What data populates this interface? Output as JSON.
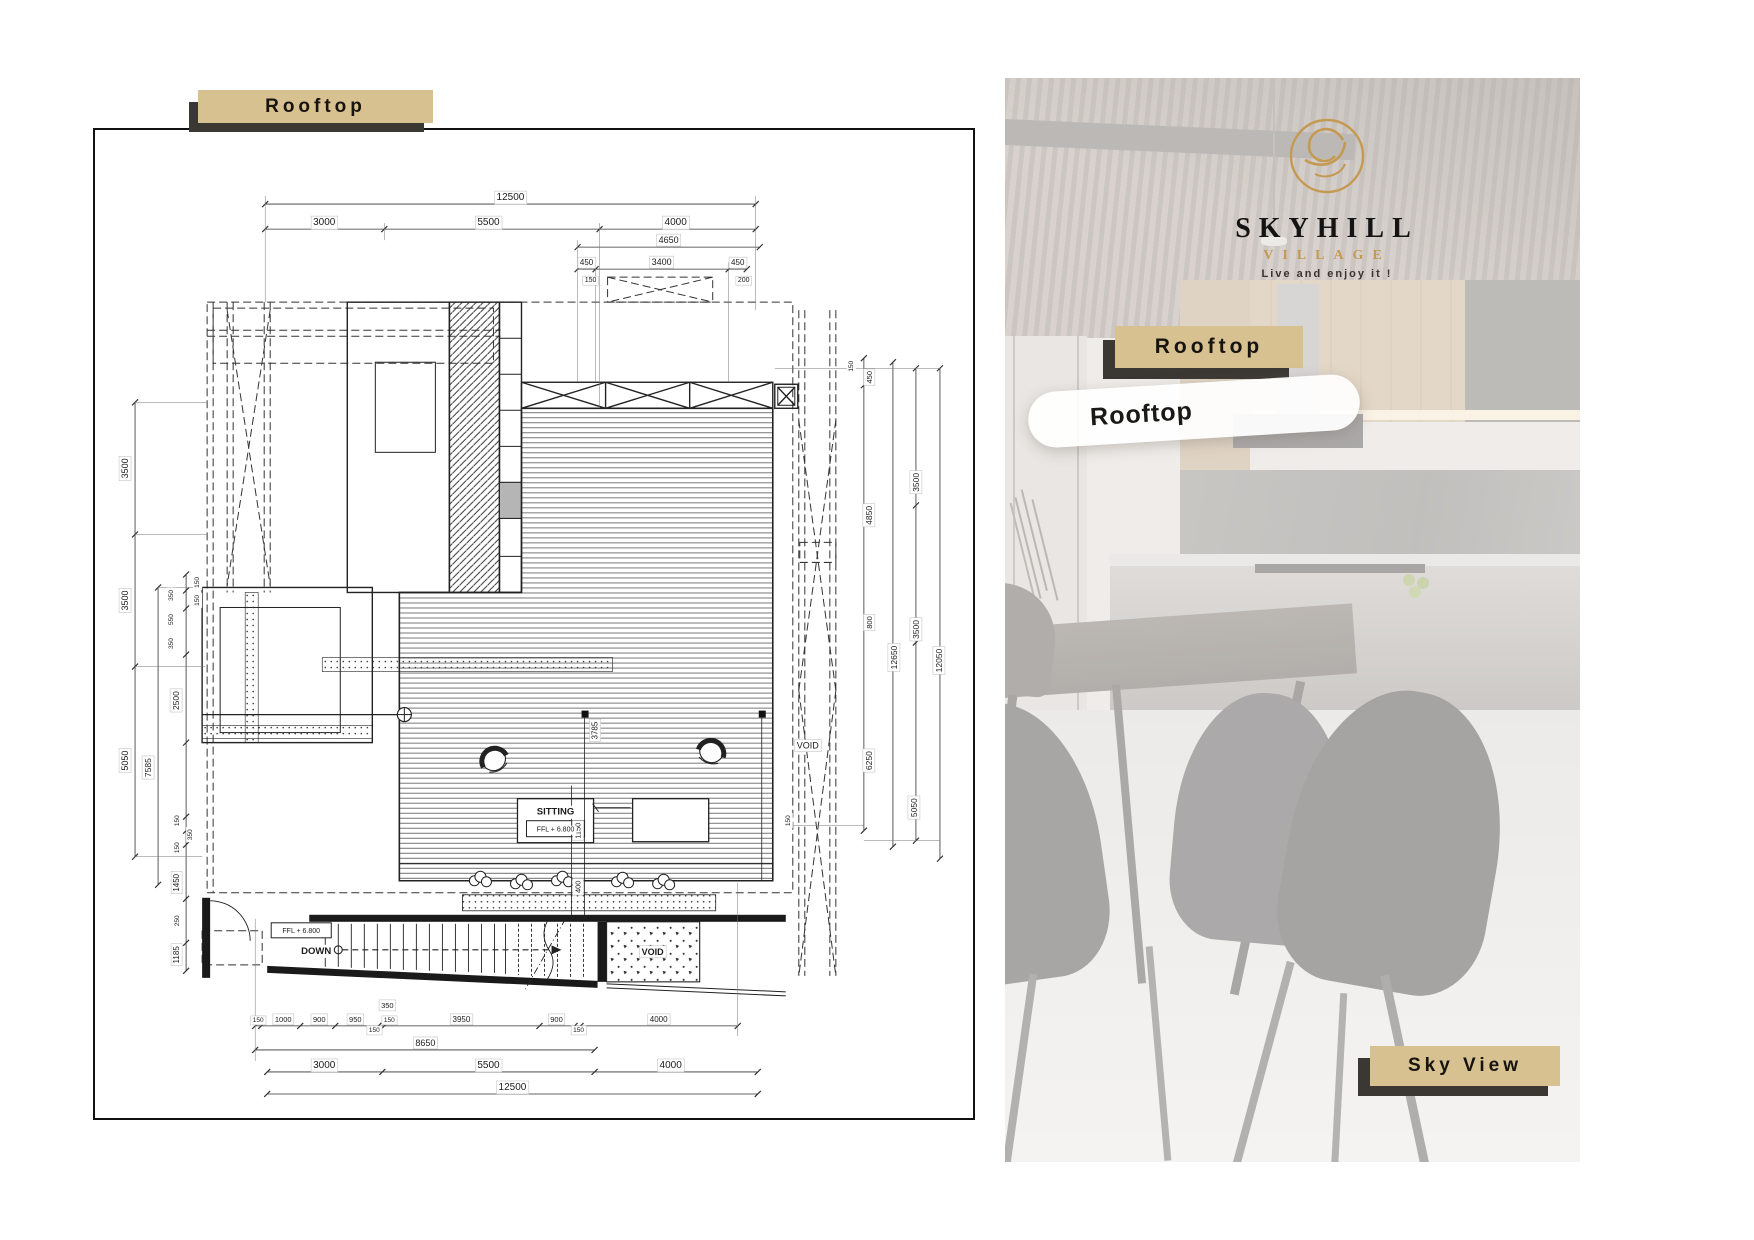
{
  "left_panel": {
    "badge_label": "Rooftop",
    "plan": {
      "dim_labels": [
        "12500",
        "3000",
        "5500",
        "4000",
        "4650",
        "450",
        "3400",
        "450",
        "150",
        "200",
        "350",
        "150",
        "1000",
        "900",
        "950",
        "150",
        "150",
        "3950",
        "900",
        "150",
        "4000",
        "8650",
        "3000",
        "5500",
        "4000",
        "12500",
        "3500",
        "3500",
        "5050",
        "7585",
        "2500",
        "150",
        "150",
        "350",
        "550",
        "350",
        "150",
        "350",
        "150",
        "1450",
        "250",
        "1185",
        "150",
        "450",
        "4850",
        "800",
        "6250",
        "150",
        "12650",
        "3500",
        "3500",
        "5050",
        "12050",
        "3785",
        "1150",
        "400",
        "SITTING",
        "FFL + 6.800",
        "FFL + 6.800",
        "DOWN",
        "VOID",
        "VOID"
      ]
    }
  },
  "right_panel": {
    "logo": {
      "brand": "SKYHILL",
      "sub": "VILLAGE",
      "tagline": "Live and enjoy it !"
    },
    "badge_label": "Rooftop",
    "caption": "Rooftop",
    "bottom_badge_label": "Sky View"
  },
  "colors": {
    "badge_bg": "#d7c190",
    "badge_shadow": "#3b3733",
    "gold": "#c49a52",
    "ink": "#141414"
  }
}
